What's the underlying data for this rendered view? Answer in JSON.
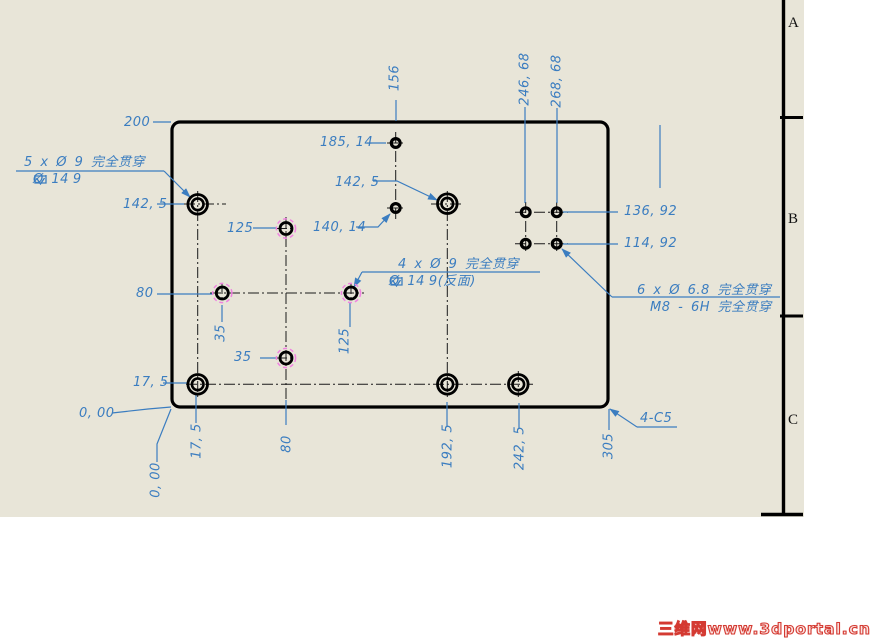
{
  "colors": {
    "dimension_blue": "#3b7dc0",
    "hidden_magenta": "#f082e1",
    "line_black": "#000000",
    "sheet_beige": "#e8e5d8",
    "watermark_red": "#d43a32",
    "paper_white": "#ffffff"
  },
  "sheet": {
    "width": 804,
    "height": 517,
    "zones": [
      {
        "letter": "A",
        "y": 16
      },
      {
        "letter": "B",
        "y": 212
      },
      {
        "letter": "C",
        "y": 413
      }
    ],
    "border": {
      "vline_x": 783.5,
      "vline_y1": 0,
      "vline_y2": 516,
      "ticks": [
        {
          "x1": 780,
          "x2": 803,
          "y": 117.5
        },
        {
          "x1": 780,
          "x2": 803,
          "y": 316
        }
      ],
      "bottom_seg": {
        "x1": 761,
        "x2": 803,
        "y": 514.5
      }
    }
  },
  "watermark": {
    "text": "三维网www.3dportal.cn"
  },
  "plate": {
    "x": 172,
    "y": 122,
    "w": 436,
    "h": 285,
    "corner": 8
  },
  "holes": {
    "counterbore_front": {
      "note_line1": "5 x Ø 9 完全贯穿",
      "note_line2": "⌴ Ø 14 ↧ 9",
      "centers": [
        [
          197.7,
          204.3
        ],
        [
          197.7,
          384.3
        ],
        [
          447.3,
          203.7
        ],
        [
          447.3,
          384.3
        ],
        [
          518.3,
          384.3
        ]
      ],
      "r_outer": 9.8,
      "r_inner": 5.8
    },
    "counterbore_back": {
      "note_line1": "4 x Ø 9 完全贯穿",
      "note_line2": "⌴ Ø 14 ↧ 9(反面)",
      "centers": [
        [
          286,
          228.5
        ],
        [
          222.3,
          293
        ],
        [
          351,
          293
        ],
        [
          286,
          358
        ]
      ],
      "r_hole": 6,
      "r_hidden": 9.6
    },
    "tapped": {
      "note_line1": "6 x Ø 6.8 完全贯穿",
      "note_line2": "M8 - 6H 完全贯穿",
      "centers": [
        [
          395.7,
          143
        ],
        [
          395.7,
          208
        ],
        [
          525.7,
          212.3
        ],
        [
          556.7,
          212.3
        ],
        [
          525.7,
          243.7
        ],
        [
          556.7,
          243.7
        ]
      ],
      "r": 4.4
    }
  },
  "notes": [
    {
      "name": "note-5x-d9",
      "lines": [
        {
          "x": 24,
          "y": 156,
          "tokens": [
            {
              "t": "5 x Ø 9 完全贯穿"
            }
          ]
        },
        {
          "x": 33,
          "y": 173,
          "tokens": [
            {
              "s": "cbore"
            },
            {
              "t": "Ø 14"
            },
            {
              "s": "depth"
            },
            {
              "t": "9"
            }
          ]
        }
      ]
    },
    {
      "name": "note-4x-d9",
      "lines": [
        {
          "x": 398,
          "y": 258,
          "tokens": [
            {
              "t": "4 x Ø 9 完全贯穿"
            }
          ]
        },
        {
          "x": 389,
          "y": 275,
          "tokens": [
            {
              "s": "cbore"
            },
            {
              "t": "Ø 14"
            },
            {
              "s": "depth"
            },
            {
              "t": "9(反面)"
            }
          ]
        }
      ]
    },
    {
      "name": "note-6x-d68",
      "lines": [
        {
          "x": 637,
          "y": 284,
          "tokens": [
            {
              "t": "6 x Ø 6.8 完全贯穿"
            }
          ]
        },
        {
          "x": 650,
          "y": 301,
          "tokens": [
            {
              "t": "M8 - 6H 完全贯穿"
            }
          ]
        }
      ]
    }
  ],
  "labels": [
    {
      "text": "200",
      "x": 124,
      "y": 116
    },
    {
      "text": "142, 5",
      "x": 123,
      "y": 198
    },
    {
      "text": "125",
      "x": 227,
      "y": 222
    },
    {
      "text": "185, 14",
      "x": 320,
      "y": 136
    },
    {
      "text": "142, 5",
      "x": 335,
      "y": 176
    },
    {
      "text": "140, 14",
      "x": 313,
      "y": 221
    },
    {
      "text": "80",
      "x": 136,
      "y": 287
    },
    {
      "text": "35",
      "x": 234,
      "y": 351
    },
    {
      "text": "17, 5",
      "x": 133,
      "y": 376
    },
    {
      "text": "0, 00",
      "x": 79,
      "y": 407
    },
    {
      "text": "136, 92",
      "x": 624,
      "y": 205
    },
    {
      "text": "114, 92",
      "x": 624,
      "y": 237
    },
    {
      "text": "4-C5",
      "x": 640,
      "y": 412
    },
    {
      "text": "156",
      "x": 395,
      "y": 78,
      "rot": 1
    },
    {
      "text": "246, 68",
      "x": 525,
      "y": 79,
      "rot": 1
    },
    {
      "text": "268, 68",
      "x": 557,
      "y": 81,
      "rot": 1
    },
    {
      "text": "35",
      "x": 221,
      "y": 333,
      "rot": 1
    },
    {
      "text": "125",
      "x": 345,
      "y": 341,
      "rot": 1
    },
    {
      "text": "0, 00",
      "x": 156,
      "y": 480,
      "rot": 1
    },
    {
      "text": "17, 5",
      "x": 197,
      "y": 441,
      "rot": 1
    },
    {
      "text": "80",
      "x": 287,
      "y": 444,
      "rot": 1
    },
    {
      "text": "192, 5",
      "x": 448,
      "y": 446,
      "rot": 1
    },
    {
      "text": "242, 5",
      "x": 520,
      "y": 448,
      "rot": 1
    },
    {
      "text": "305",
      "x": 609,
      "y": 446,
      "rot": 1
    }
  ],
  "dim_lines": [
    {
      "pts": [
        [
          153,
          122
        ],
        [
          171,
          122
        ]
      ]
    },
    {
      "pts": [
        [
          16,
          171
        ],
        [
          164,
          171
        ]
      ]
    },
    {
      "pts": [
        [
          164,
          171
        ],
        [
          190,
          197
        ]
      ],
      "arrow": 1
    },
    {
      "pts": [
        [
          157,
          204
        ],
        [
          184,
          204
        ]
      ]
    },
    {
      "pts": [
        [
          253,
          228
        ],
        [
          277,
          228
        ]
      ]
    },
    {
      "pts": [
        [
          396,
          100
        ],
        [
          396,
          121
        ]
      ]
    },
    {
      "pts": [
        [
          367,
          143
        ],
        [
          386,
          143
        ]
      ]
    },
    {
      "pts": [
        [
          373,
          181
        ],
        [
          397,
          181
        ],
        [
          437,
          200
        ]
      ],
      "arrow": 1
    },
    {
      "pts": [
        [
          356,
          227
        ],
        [
          378,
          227
        ],
        [
          390,
          214
        ]
      ],
      "arrow": 1
    },
    {
      "pts": [
        [
          525,
          107
        ],
        [
          525,
          203
        ]
      ]
    },
    {
      "pts": [
        [
          557,
          108
        ],
        [
          557,
          203
        ]
      ]
    },
    {
      "pts": [
        [
          660,
          125
        ],
        [
          660,
          188
        ]
      ]
    },
    {
      "pts": [
        [
          563,
          212
        ],
        [
          618,
          212
        ]
      ]
    },
    {
      "pts": [
        [
          563,
          244
        ],
        [
          618,
          244
        ]
      ]
    },
    {
      "pts": [
        [
          612,
          297
        ],
        [
          780,
          297
        ]
      ]
    },
    {
      "pts": [
        [
          612,
          297
        ],
        [
          562,
          249
        ]
      ],
      "arrow": 1
    },
    {
      "pts": [
        [
          362,
          272
        ],
        [
          540,
          272
        ]
      ]
    },
    {
      "pts": [
        [
          362,
          272
        ],
        [
          354,
          287
        ]
      ],
      "arrow": 1
    },
    {
      "pts": [
        [
          157,
          294
        ],
        [
          213,
          294
        ]
      ]
    },
    {
      "pts": [
        [
          222,
          305
        ],
        [
          222,
          322
        ]
      ]
    },
    {
      "pts": [
        [
          260,
          358
        ],
        [
          277,
          358
        ]
      ]
    },
    {
      "pts": [
        [
          350,
          303
        ],
        [
          350,
          327
        ]
      ]
    },
    {
      "pts": [
        [
          163,
          383
        ],
        [
          187,
          383
        ]
      ]
    },
    {
      "pts": [
        [
          112,
          413
        ],
        [
          148,
          409
        ],
        [
          171,
          407
        ]
      ]
    },
    {
      "pts": [
        [
          157,
          462
        ],
        [
          157,
          444
        ],
        [
          171,
          409
        ]
      ]
    },
    {
      "pts": [
        [
          196,
          394
        ],
        [
          196,
          423
        ]
      ]
    },
    {
      "pts": [
        [
          286,
          400
        ],
        [
          286,
          425
        ]
      ]
    },
    {
      "pts": [
        [
          447,
          402
        ],
        [
          447,
          427
        ]
      ]
    },
    {
      "pts": [
        [
          519,
          403
        ],
        [
          519,
          428
        ]
      ]
    },
    {
      "pts": [
        [
          609,
          409
        ],
        [
          609,
          430
        ]
      ]
    },
    {
      "pts": [
        [
          637,
          427
        ],
        [
          677,
          427
        ]
      ]
    },
    {
      "pts": [
        [
          637,
          427
        ],
        [
          610,
          409
        ]
      ],
      "arrow": 1
    }
  ],
  "centerlines": [
    [
      197.7,
      191,
      197.7,
      397
    ],
    [
      184,
      204,
      226,
      204
    ],
    [
      431,
      204,
      463,
      204
    ],
    [
      447.3,
      191,
      447.3,
      397
    ],
    [
      186,
      384.3,
      533,
      384.3
    ],
    [
      286,
      217,
      286,
      401
    ],
    [
      210,
      293,
      364,
      293
    ],
    [
      395.7,
      132,
      395.7,
      221
    ],
    [
      515,
      212.3,
      568,
      212.3
    ],
    [
      515,
      243.7,
      568,
      243.7
    ],
    [
      525.7,
      202,
      525.7,
      254
    ],
    [
      556.7,
      202,
      556.7,
      254
    ],
    [
      387,
      143,
      404,
      143
    ],
    [
      387,
      208,
      404,
      208
    ],
    [
      276,
      228.5,
      296,
      228.5
    ],
    [
      276,
      358,
      296,
      358
    ],
    [
      222,
      283,
      222,
      303
    ],
    [
      351,
      283,
      351,
      303
    ],
    [
      518.3,
      371,
      518.3,
      397
    ]
  ]
}
